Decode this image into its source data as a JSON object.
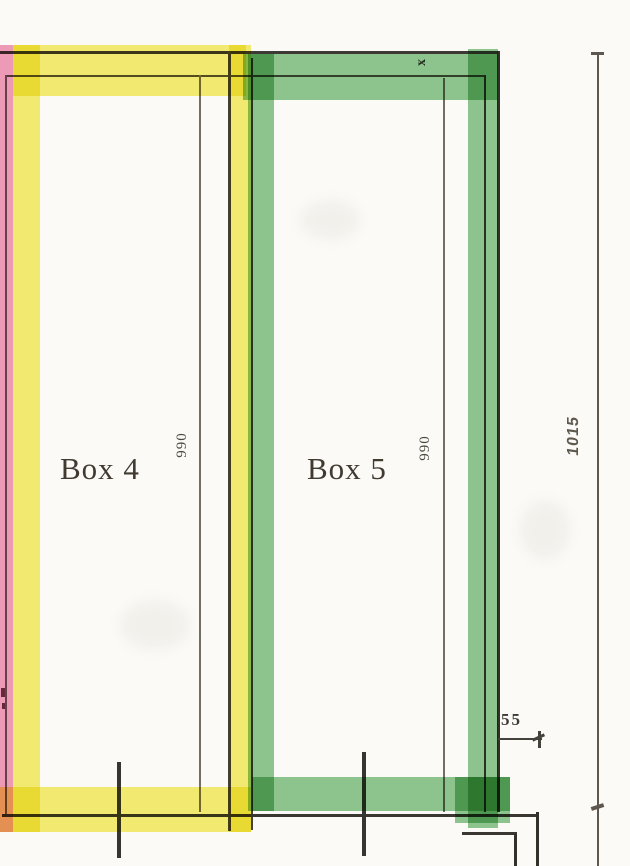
{
  "drawing": {
    "boxes": [
      {
        "label": "Box 4",
        "width_dim": "990",
        "highlight_color": "#f4ea55"
      },
      {
        "label": "Box 5",
        "width_dim": "990",
        "highlight_color": "#80c083"
      }
    ],
    "dims": {
      "right_total": "1015",
      "bottom_offset": "55",
      "top_marker": "x"
    },
    "colors": {
      "paper": "#fbfaf6",
      "ink": "#46423c",
      "pink_highlight": "#ef8cb1",
      "yellow_highlight": "#f4ea55",
      "green_highlight": "#80c083"
    }
  }
}
